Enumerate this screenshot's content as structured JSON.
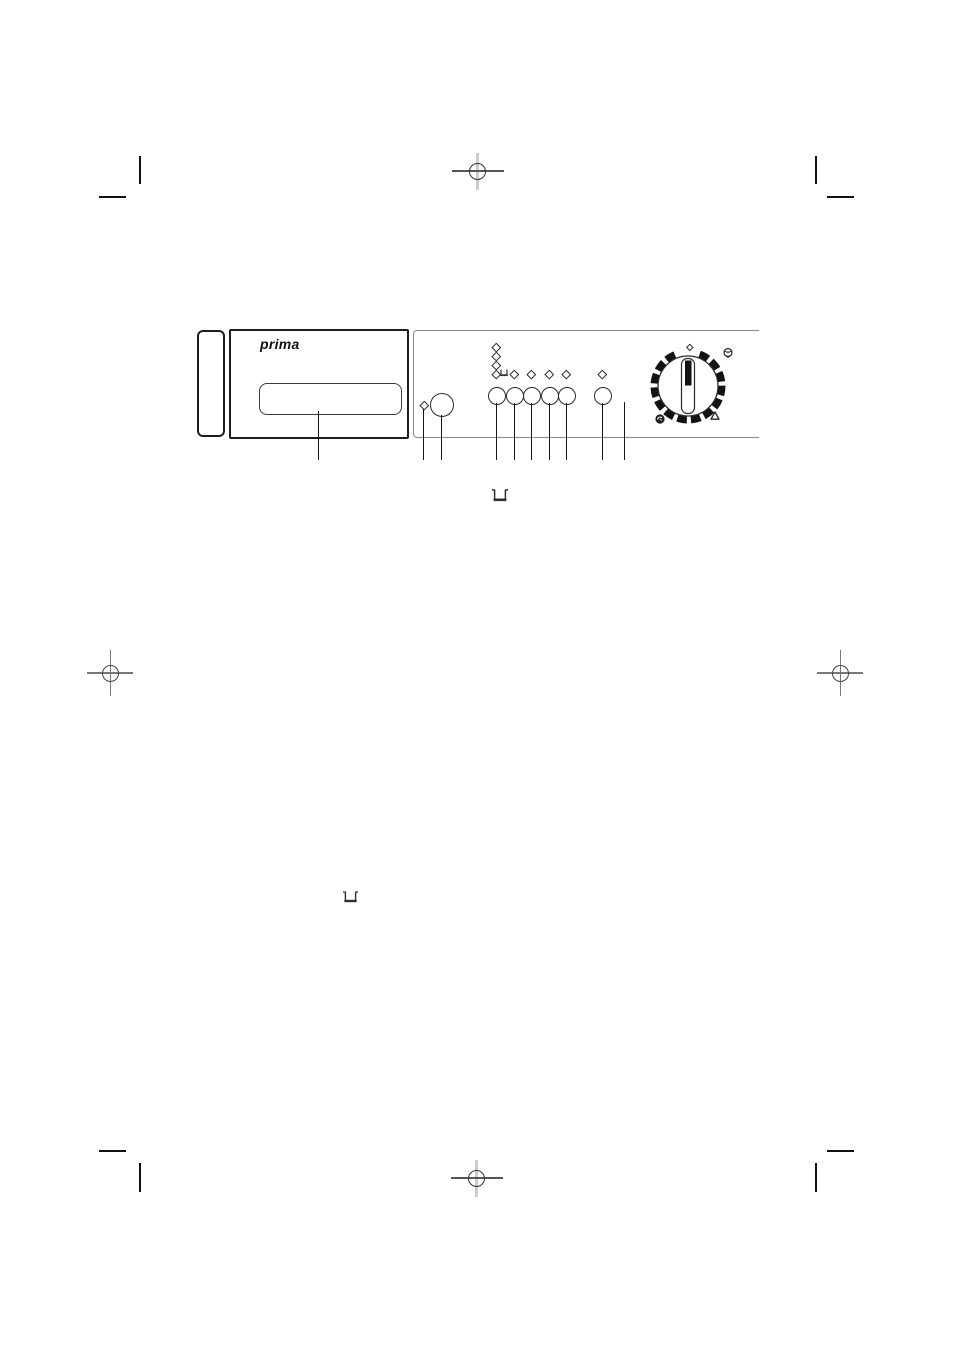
{
  "page": {
    "kind": "scanned manual page",
    "background": "#ffffff"
  },
  "colors": {
    "ink": "#1c1c1c",
    "panel_outline_gray": "#8c8c8c",
    "callout_line": "#161616",
    "registration_bar_gray": "#cccccc",
    "crosshair_gray": "#777777"
  },
  "figure": {
    "brand_label": "prima",
    "description": "washing machine fascia diagram",
    "leds": {
      "power_led_count": 1,
      "phase_column_led_count": 4,
      "option_row_led_count": 5,
      "dial_led_count": 1
    },
    "buttons": {
      "power_button_count": 1,
      "small_button_count": 6
    },
    "icons": {
      "detergent_tray": "open tub outline",
      "dial_top_right": "wool skein",
      "dial_bottom_right": "drop / rinse outline",
      "dial_bottom_left": "spin swirl (filled)"
    },
    "dial": {
      "style": "rotary knob with segmented black ring and vertical pointer"
    }
  },
  "inline_icons": [
    {
      "name": "detergent-tub-icon",
      "position": "below figure"
    },
    {
      "name": "detergent-tub-icon",
      "position": "mid page"
    }
  ]
}
